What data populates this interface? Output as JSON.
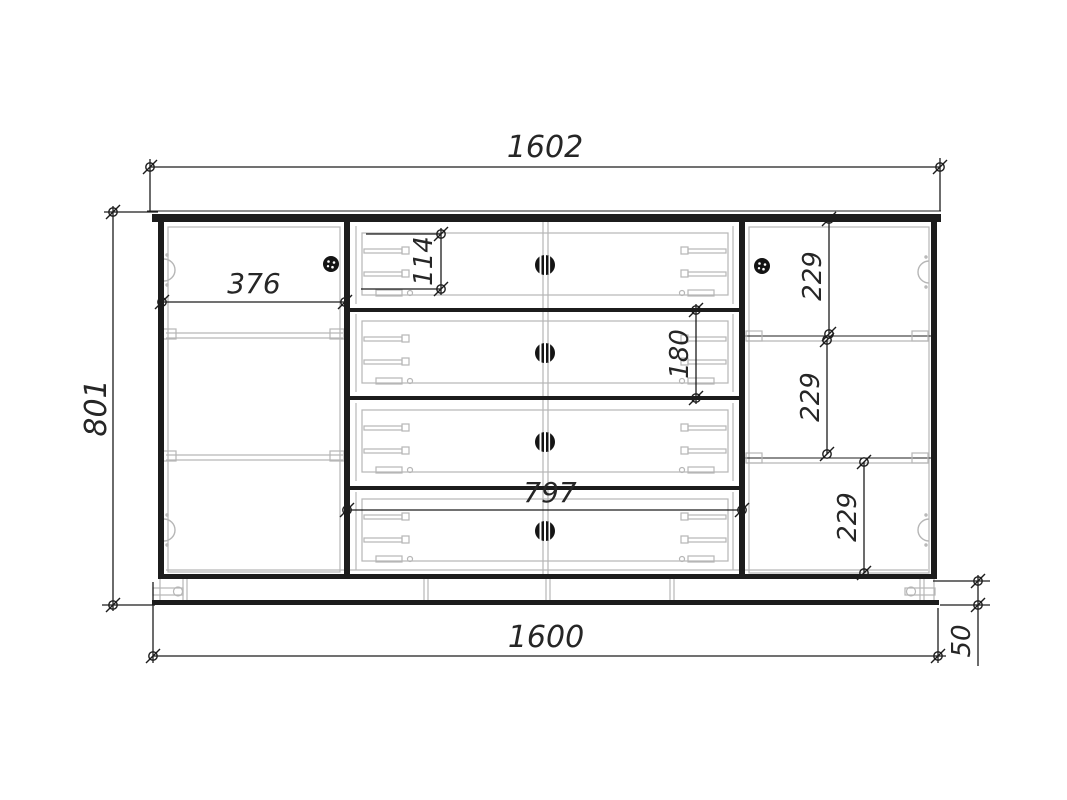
{
  "drawing": {
    "name": "cabinet-assembly-front-view",
    "description": "Dimensioned front view of a sideboard: left hinged door, four central drawers, right hinged door with two shelves, on a plinth with legs"
  },
  "dimensions": {
    "top_width": "1602",
    "overall_height": "801",
    "left_section_width": "376",
    "drawer_side_height": "114",
    "drawer_front_height": "180",
    "drawer_section_width": "797",
    "right_gap_top": "229",
    "right_gap_middle": "229",
    "right_gap_bottom": "229",
    "body_width": "1600",
    "plinth_height": "50"
  },
  "colors": {
    "background": "#ffffff",
    "main_line": "#1c1c1c",
    "light_line": "#b6b6b6",
    "text": "#262626"
  }
}
